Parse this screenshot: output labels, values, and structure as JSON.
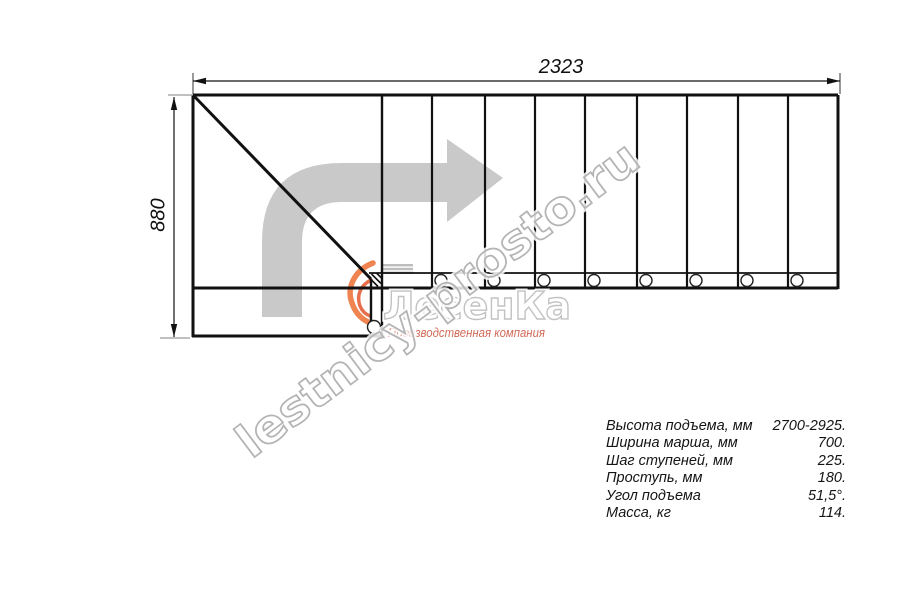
{
  "drawing": {
    "type": "staircase-plan-top-view",
    "dimensions": {
      "width_label": "2323",
      "height_label": "880"
    },
    "watermark": "lestnicy-prosto.ru",
    "logo": {
      "name": "ЛесенКа",
      "tagline": "Производственная компания"
    },
    "steps_in_upper_flight": 9,
    "support_circles": 9
  },
  "specs": {
    "rows": [
      {
        "label": "Высота подъема, мм",
        "value": "2700-2925."
      },
      {
        "label": "Ширина марша, мм",
        "value": "700."
      },
      {
        "label": "Шаг ступеней, мм",
        "value": "225."
      },
      {
        "label": "Проступь, мм",
        "value": "180."
      },
      {
        "label": "Угол подъема",
        "value": "51,5°."
      },
      {
        "label": "Масса, кг",
        "value": "114."
      }
    ]
  },
  "colors": {
    "line": "#111111",
    "extension_gray": "#9a9a9a",
    "direction_arrow": "#c9c9c9",
    "watermark_outline": "#b4b4b4",
    "logo_outline": "#c2c2c2",
    "tagline_red": "#c9503c",
    "swoosh_orange": "#ed6f33"
  }
}
